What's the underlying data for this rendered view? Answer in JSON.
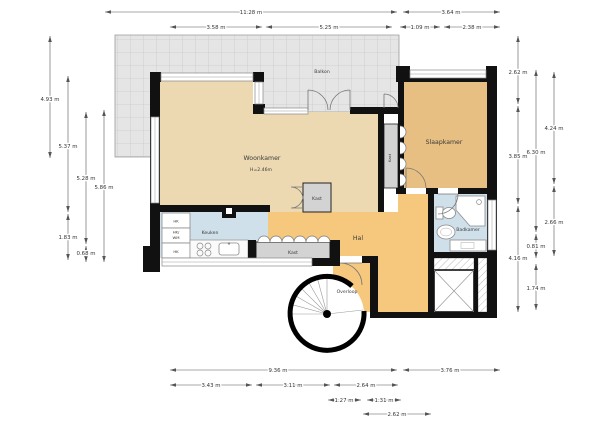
{
  "floorplan": {
    "rooms": {
      "balkon": {
        "label": "Balkon"
      },
      "woonkamer": {
        "label": "Woonkamer",
        "ceiling_height": "H=2.46m"
      },
      "slaapkamer": {
        "label": "Slaapkamer"
      },
      "keuken": {
        "label": "Keuken"
      },
      "hal": {
        "label": "Hal"
      },
      "badkamer": {
        "label": "Badkamer"
      },
      "overloop": {
        "label": "Overloop"
      },
      "kast_woonkamer": {
        "label": "Kast"
      },
      "kast_hal": {
        "label": "Kast"
      },
      "kast_slaapkamer": {
        "label": "Kast"
      }
    },
    "cupboards": {
      "hk_top": "HK",
      "hk_wm_line1": "HK/",
      "hk_wm_line2": "WM",
      "hk_bottom": "HK"
    },
    "dimensions": {
      "top": [
        "11.28 m",
        "3.64 m",
        "3.58 m",
        "5.25 m",
        "1.09 m",
        "2.38 m"
      ],
      "left": [
        "4.93 m",
        "5.37 m",
        "1.83 m",
        "5.28 m",
        "0.68 m",
        "5.86 m"
      ],
      "right": [
        "2.62 m",
        "3.85 m",
        "4.16 m",
        "6.30 m",
        "0.81 m",
        "1.74 m",
        "4.24 m",
        "2.66 m"
      ],
      "bottom": [
        "9.36 m",
        "3.76 m",
        "3.43 m",
        "3.11 m",
        "2.64 m",
        "1.27 m",
        "1.31 m",
        "2.62 m"
      ]
    },
    "colors": {
      "living": "#ecd9b1",
      "bedroom": "#e7bf82",
      "hall": "#f6c87e",
      "wet": "#cfe0eb",
      "balcony_fill": "#e5e5e5",
      "closet": "#d3d3d3"
    }
  }
}
